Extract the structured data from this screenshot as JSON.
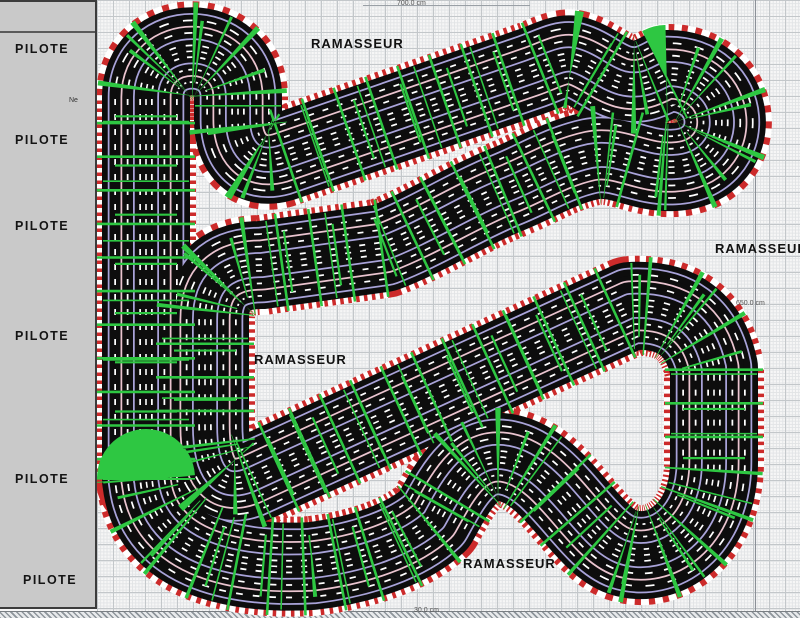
{
  "sidebar": {
    "stations": [
      {
        "label": "PILOTE"
      },
      {
        "label": "PILOTE"
      },
      {
        "label": "PILOTE"
      },
      {
        "label": "PILOTE"
      },
      {
        "label": "PILOTE"
      },
      {
        "label": "PILOTE"
      }
    ],
    "note_label": "Ne",
    "bg_color": "#c9c9c9"
  },
  "canvas": {
    "marshal_labels": [
      {
        "text": "RAMASSEUR"
      },
      {
        "text": "RAMASSEUR"
      },
      {
        "text": "RAMASSEUR"
      },
      {
        "text": "RAMASSEUR"
      }
    ],
    "dimensions": [
      {
        "text": "700.0 cm"
      },
      {
        "text": "650.0 cm"
      },
      {
        "text": "30.0 cm"
      }
    ],
    "track": {
      "lane_count": 6,
      "colors": {
        "curb_red": "#cc2b2b",
        "surface": "#0d0d0d",
        "divider_lavender": "#a9a3d9",
        "divider_pink": "#eac4cf",
        "slot_dash": "#ffffff",
        "marker_green": "#2ec742"
      },
      "path": "M 146 480 L 146 97 C 146 36 238 36 238 97 L 238 120 C 238 146 252 166 280 158 L 530 72 C 548 66 562 57 574 60 C 592 65 604 78 622 83 C 642 88 654 80 666 74 C 736 72 742 164 674 167 C 642 169 618 150 590 156 C 558 163 536 178 506 190 C 466 206 426 232 384 248 L 262 265 Q 205 265 205 320 L 205 425 C 205 472 220 492 250 480 L 630 306 Q 700 302 714 368 L 714 462 C 714 532 664 566 622 552 C 584 538 556 468 508 458 C 470 450 452 488 434 520 C 408 544 362 560 312 566 C 246 570 152 558 146 478 Z"
    }
  }
}
